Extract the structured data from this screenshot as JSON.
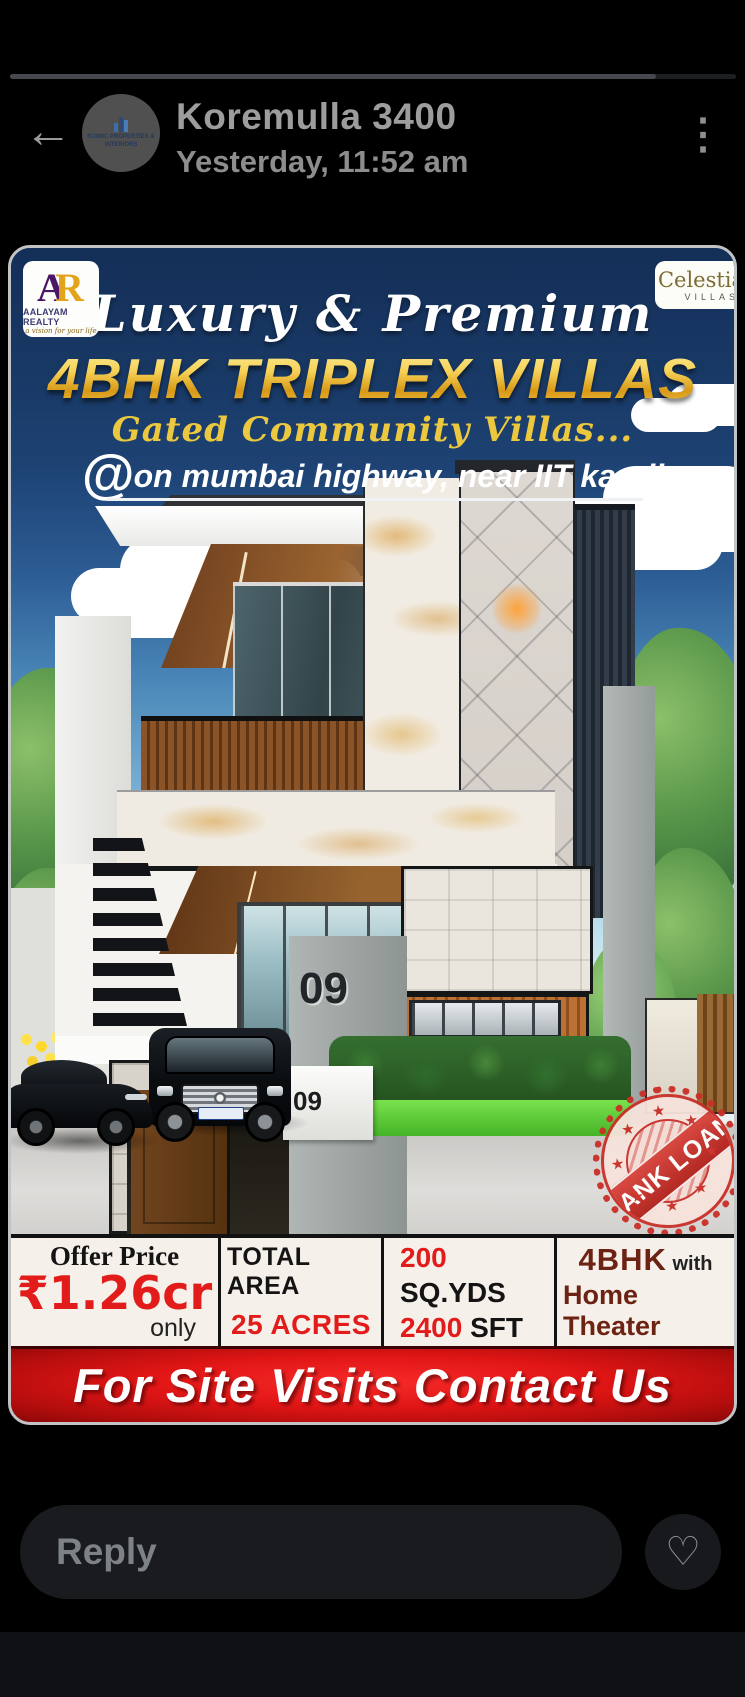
{
  "header": {
    "back_icon": "←",
    "menu_icon": "⋮",
    "title": "Koremulla 3400",
    "timestamp": "Yesterday, 11:52 am",
    "avatar": {
      "line1": "ICONIC PROPERTIES &",
      "line2": "INTERIORS"
    }
  },
  "poster": {
    "brand_left": {
      "letter_a": "A",
      "letter_r": "R",
      "name": "AALAYAM REALTY",
      "tagline": "a vision for your life"
    },
    "brand_right": {
      "name": "Celestia",
      "sub": "VILLAS"
    },
    "script_title": "Luxury & Premium",
    "main_title": "4BHK TRIPLEX VILLAS",
    "sub_title": "Gated Community Villas...",
    "at_symbol": "@",
    "location": "on mumbai highway, near IIT kandi",
    "house_number": "09",
    "gate_number": "09",
    "stamp": {
      "text": "BANK LOAN",
      "star": "★"
    },
    "info": {
      "offer": {
        "label": "Offer Price",
        "value": "₹1.26cr",
        "suffix": "only"
      },
      "area": {
        "label": "TOTAL AREA",
        "value": "25 ACRES"
      },
      "size": {
        "v1": "200",
        "u1": " SQ.YDS",
        "v2": "2400",
        "u2": " SFT"
      },
      "bhk": {
        "strong": "4BHK",
        "rest": " with",
        "line2": "Home Theater"
      }
    },
    "banner": "For Site Visits Contact Us",
    "colors": {
      "accent_red": "#e21b1b",
      "gold": "#f2c63d",
      "navy": "#17345f",
      "maroon": "#6d2313"
    }
  },
  "footer": {
    "reply_placeholder": "Reply",
    "heart_icon": "♡"
  }
}
